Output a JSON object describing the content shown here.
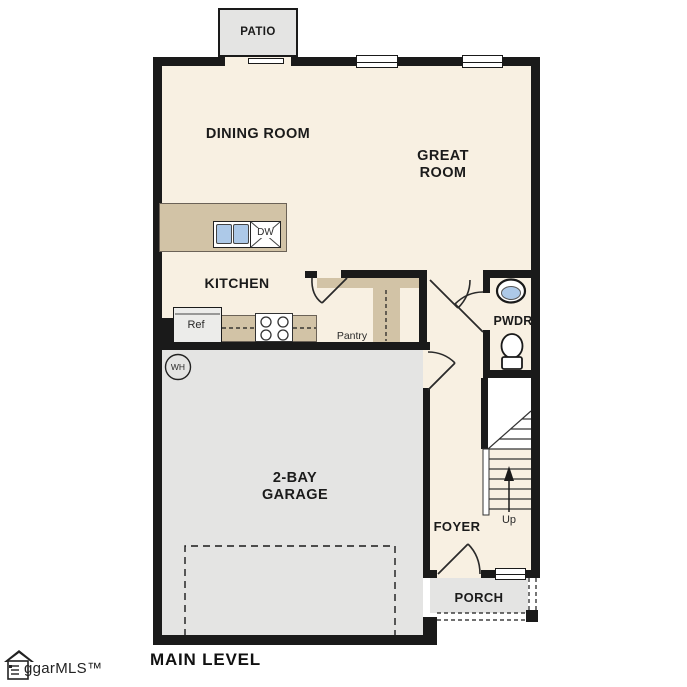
{
  "title": "MAIN LEVEL",
  "watermark": {
    "label": "ggarMLS™"
  },
  "colors": {
    "floor": "#f8f0e2",
    "wall": "#1a1a1a",
    "counter": "#d2c3a6",
    "concrete": "#e4e4e3",
    "sink": "#adc9e8"
  },
  "rooms": {
    "patio": "PATIO",
    "dining": "DINING ROOM",
    "great": "GREAT\nROOM",
    "kitchen": "KITCHEN",
    "pwdr": "PWDR",
    "pantry": "Pantry",
    "garage": "2-BAY\nGARAGE",
    "foyer": "FOYER",
    "porch": "PORCH"
  },
  "fixtures": {
    "ref": "Ref",
    "dw": "DW",
    "wh": "WH",
    "stairs_up": "Up"
  }
}
